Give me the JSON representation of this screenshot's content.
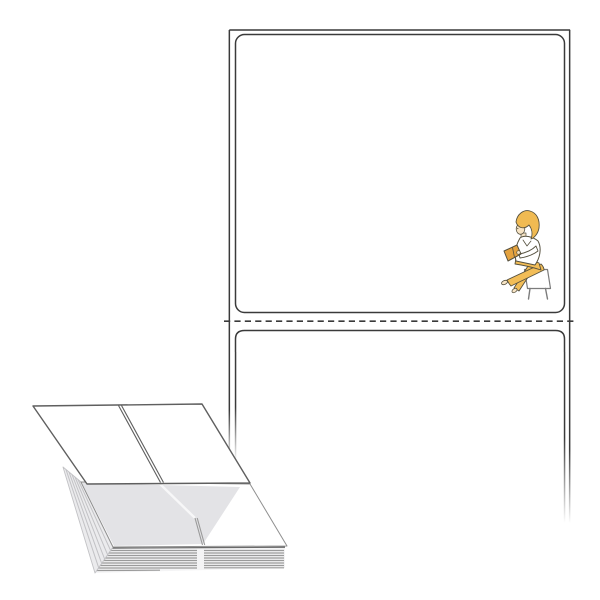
{
  "scene": {
    "type": "product-illustration",
    "subject": "fanfold perforated label sheet with reading figure and folded label stack",
    "labels_visible_on_sheet": 2,
    "perforation_style": "dashed tear line",
    "figure": "woman reading a book seated on a stool",
    "stack": "fanfold accordion-folded label stack with top sheet lifted"
  },
  "colors": {
    "bg": "#ffffff",
    "white": "#ffffff",
    "outline": "#3a3a3a",
    "sheet-outline": "#5f5f5f",
    "panel-outline": "#8f8f8f",
    "layer-line": "#9a9a9a",
    "face-top-line": "#6a6a6a",
    "stack-face": "#f4f4f5",
    "shadow": "#e3e3e6",
    "left-face": "#ebebed",
    "left-face-line": "#c2c2c5",
    "perf-light": "#f7f7f8",
    "hair": "#f0ba52",
    "pants": "#f2bd57",
    "book": "#e4a23e",
    "skin": "#f7e4c5",
    "figure-outline": "#56513f",
    "stool-outline": "#7c7c7c"
  }
}
